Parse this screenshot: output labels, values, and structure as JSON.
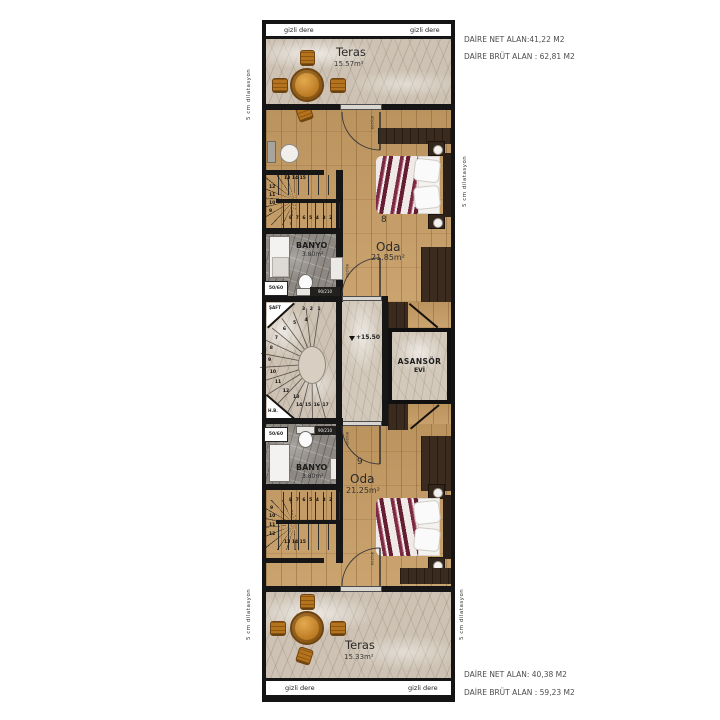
{
  "annotations": {
    "top_unit_net": "DAİRE NET ALAN:41,22 M2",
    "top_unit_brut": "DAİRE BRÜT ALAN : 62,81 M2",
    "bottom_unit_net": "DAİRE NET ALAN: 40,38 M2",
    "bottom_unit_brut": "DAİRE BRÜT ALAN : 59,23 M2"
  },
  "plan": {
    "gizli_dere": "gizli dere",
    "dilatasyon": "5 cm dilatasyon",
    "terrace_top": {
      "name": "Teras",
      "area": "15.57m²"
    },
    "terrace_bottom": {
      "name": "Teras",
      "area": "15.33m²"
    },
    "room_top": {
      "number": "8",
      "name": "Oda",
      "area": "21.85m²"
    },
    "room_bottom": {
      "number": "9",
      "name": "Oda",
      "area": "21.25m²"
    },
    "bathroom_top": {
      "name": "BANYO",
      "area": "3.80m²",
      "window": "50/60",
      "door": "90/210"
    },
    "bathroom_bottom": {
      "name": "BANYO",
      "area": "3.80m²",
      "window": "50/60",
      "door": "90/210"
    },
    "landing": {
      "shaft": "ŞAFT",
      "half_bath": "H.B.",
      "level": "+15.50",
      "elevator_line1": "ASANSÖR",
      "elevator_line2": "EVİ"
    },
    "door_size": "80/205",
    "stairs_top": {
      "row_top": "13  14  15",
      "col": [
        "12",
        "11",
        "10",
        "9"
      ],
      "row_bottom": "8 7 6 5 4 3 2"
    },
    "stairs_bottom": {
      "row_top": "8 7 6 5 4 3 2",
      "col": [
        "9",
        "10",
        "11",
        "12"
      ],
      "row_bottom": "13  14  15"
    },
    "spiral": {
      "row_top": "3 2 1",
      "arc": [
        "4",
        "5",
        "6",
        "7",
        "8",
        "9",
        "10",
        "11",
        "12",
        "13"
      ],
      "row_bottom": "14 15 16 17"
    }
  }
}
